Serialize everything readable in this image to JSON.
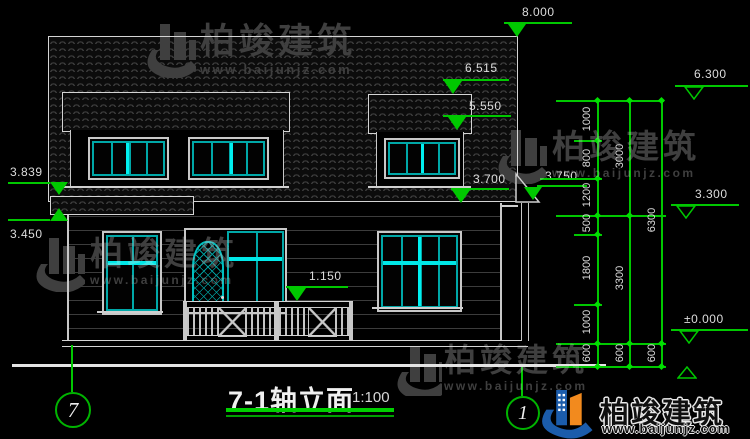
{
  "colors": {
    "dim_green": "#00c800",
    "bright_green": "#00e000",
    "frame_white": "#c8c8c8",
    "glass_teal": "#00a8a8",
    "glass_bright": "#00f0f0",
    "logo_blue": "#1b5cab",
    "logo_orange": "#f28a1e",
    "background": "#000000"
  },
  "watermark": {
    "brand": "柏竣建筑",
    "url": "www.baijunjz.com"
  },
  "title_block": {
    "title": "7-1轴立面",
    "scale": "1:100"
  },
  "axis_bubbles": {
    "left": "7",
    "right": "1"
  },
  "elevations": {
    "peak": "8.000",
    "dormer_top": "6.515",
    "dormer_eave": "5.550",
    "right_top": "6.300",
    "canopy_top": "3.839",
    "canopy_bottom": "3.450",
    "eave_main": "3.700",
    "eave_right": "3.750",
    "floor2": "3.300",
    "porch_rail": "1.150",
    "ground_zero": "±0.000"
  },
  "dim_chains": {
    "inner": [
      "1000",
      "800",
      "1200",
      "500",
      "1800",
      "1000",
      "600"
    ],
    "middle": [
      "3000",
      "3300",
      "600"
    ],
    "outer": [
      "6300",
      "600"
    ]
  }
}
